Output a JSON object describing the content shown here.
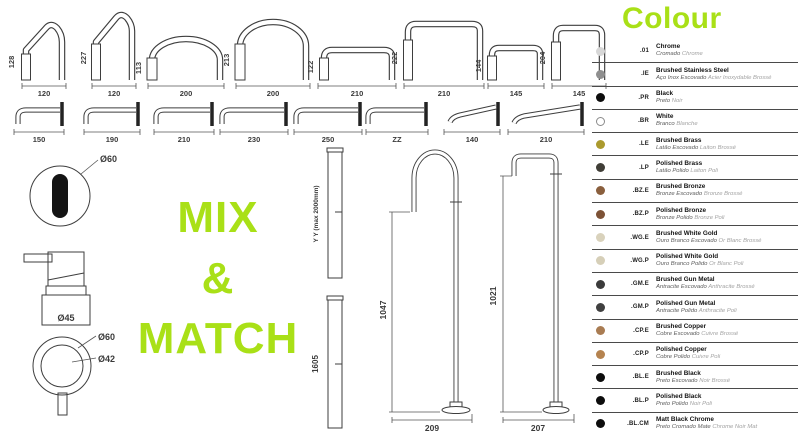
{
  "green": "#a9e017",
  "mix_match": {
    "line1": "MIX",
    "line2": "&",
    "line3": "MATCH"
  },
  "top_spouts": [
    {
      "h": "128",
      "w": "120"
    },
    {
      "h": "227",
      "w": "120"
    },
    {
      "h": "113",
      "w": "200"
    },
    {
      "h": "213",
      "w": "200"
    },
    {
      "h": "122",
      "w": "210"
    },
    {
      "h": "222",
      "w": "210"
    },
    {
      "h": "144",
      "w": "145"
    },
    {
      "h": "204",
      "w": "145"
    }
  ],
  "wall_spouts": [
    "150",
    "190",
    "210",
    "230",
    "250",
    "ZZ",
    "140",
    "210"
  ],
  "components": {
    "sensor_d": "Ø60",
    "dispenser_d": "Ø45",
    "knob_outer": "Ø60",
    "knob_inner": "Ø42"
  },
  "columns": {
    "yy": "Y Y (max 2000mm)",
    "h": "1605"
  },
  "floor_spouts": [
    {
      "h": "1047",
      "w": "209"
    },
    {
      "h": "1021",
      "w": "207"
    }
  ],
  "colour_legend": {
    "title": "Colour",
    "items": [
      {
        "code": ".01",
        "name": "Chrome",
        "pt": "Cromado",
        "fr": "Chrome",
        "swatch": "#d7d7d7"
      },
      {
        "code": ".IE",
        "name": "Brushed Stainless Steel",
        "pt": "Aço Inox Escovado",
        "fr": "Acier Inoxydable Brossé",
        "swatch": "#8f8f8f"
      },
      {
        "code": ".PR",
        "name": "Black",
        "pt": "Preto",
        "fr": "Noir",
        "swatch": "#0d0d0d"
      },
      {
        "code": ".BR",
        "name": "White",
        "pt": "Branco",
        "fr": "Blanche",
        "swatch": "#ffffff"
      },
      {
        "code": ".LE",
        "name": "Brushed Brass",
        "pt": "Latão Escovado",
        "fr": "Laiton Brossé",
        "swatch": "#ab9a2e"
      },
      {
        "code": ".LP",
        "name": "Polished Brass",
        "pt": "Latão Polido",
        "fr": "Laiton Poli",
        "swatch": "#403e37"
      },
      {
        "code": ".BZ.E",
        "name": "Brushed Bronze",
        "pt": "Bronze Escovado",
        "fr": "Bronze Brossé",
        "swatch": "#8a5f3d"
      },
      {
        "code": ".BZ.P",
        "name": "Polished Bronze",
        "pt": "Bronze Polido",
        "fr": "Bronze Poli",
        "swatch": "#7d5236"
      },
      {
        "code": ".WG.E",
        "name": "Brushed White Gold",
        "pt": "Ouro Branco Escovado",
        "fr": "Or Blanc Brossé",
        "swatch": "#d9d2bc"
      },
      {
        "code": ".WG.P",
        "name": "Polished White Gold",
        "pt": "Ouro Branco Polido",
        "fr": "Or Blanc Poli",
        "swatch": "#d6cfb8"
      },
      {
        "code": ".GM.E",
        "name": "Brushed Gun Metal",
        "pt": "Antracite Escovado",
        "fr": "Anthracite Brossé",
        "swatch": "#3b3b3b"
      },
      {
        "code": ".GM.P",
        "name": "Polished Gun Metal",
        "pt": "Antracite Polido",
        "fr": "Anthracite Poli",
        "swatch": "#404040"
      },
      {
        "code": ".CP.E",
        "name": "Brushed Copper",
        "pt": "Cobre Escovado",
        "fr": "Cuivre Brossé",
        "swatch": "#a97c52"
      },
      {
        "code": ".CP.P",
        "name": "Polished Copper",
        "pt": "Cobre Polido",
        "fr": "Cuivre Poli",
        "swatch": "#b5834f"
      },
      {
        "code": ".BL.E",
        "name": "Brushed Black",
        "pt": "Preto Escovado",
        "fr": "Noir Brossé",
        "swatch": "#0d0d0d"
      },
      {
        "code": ".BL.P",
        "name": "Polished Black",
        "pt": "Preto Polido",
        "fr": "Noir Poli",
        "swatch": "#0d0d0d"
      },
      {
        "code": ".BL.CM",
        "name": "Matt Black Chrome",
        "pt": "Preto Cromado Mate",
        "fr": "Chrome Noir Mat",
        "swatch": "#0d0d0d"
      }
    ]
  }
}
